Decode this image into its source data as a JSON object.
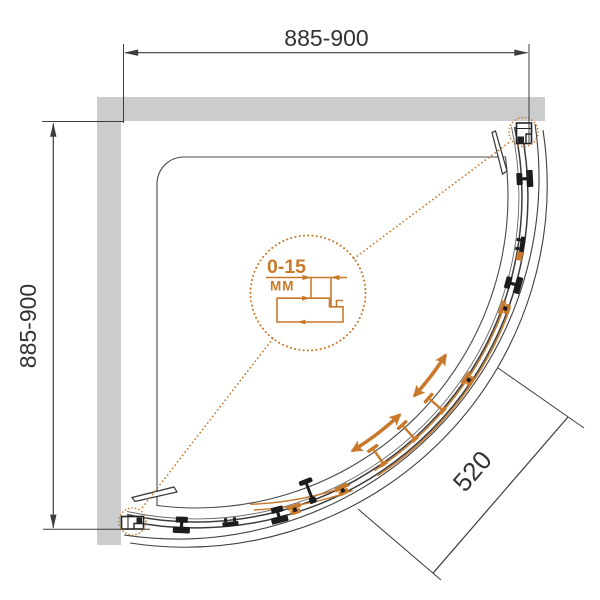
{
  "drawing": {
    "subject": "quarter-round shower enclosure top view",
    "dimensions": {
      "top_width": "885-900",
      "left_depth": "885-900",
      "door_opening": "520"
    },
    "detail_callout": {
      "adjustment_range": "0-15",
      "unit": "MM"
    },
    "colors": {
      "accent_orange": "#c8792b",
      "line_dark": "#3c3c3c",
      "wall_gray": "#cacccd",
      "background": "#ffffff"
    },
    "icons": {
      "callout": "dotted-circle-callout-icon",
      "slide_direction": "curved-double-arrow-icon",
      "roller": "roller-block-icon",
      "hanger": "door-hanger-icon",
      "handle": "door-knob-icon",
      "wall_profile": "wall-bracket-icon"
    }
  }
}
